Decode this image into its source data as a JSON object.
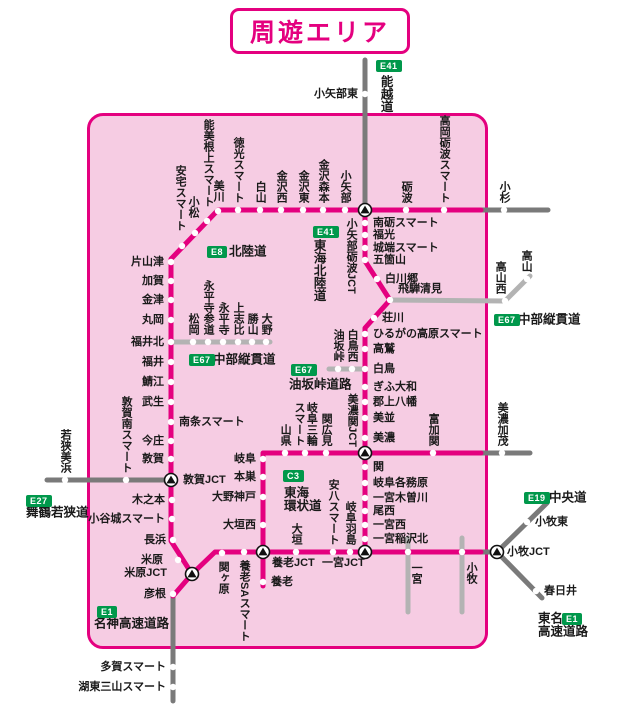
{
  "title": {
    "text": "周遊エリア"
  },
  "colors": {
    "pink": "#e4007f",
    "gray": "#7a7a7a",
    "lightgray": "#b3b3b3",
    "area_fill": "#f6cce3",
    "badge_green": "#00984b",
    "text": "#1a1a1a"
  },
  "map": {
    "area": {
      "x": 87,
      "y": 113,
      "w": 395,
      "h": 530
    },
    "lines": [
      {
        "name": "noetsu-expressway-line",
        "color": "gray",
        "points": [
          [
            365,
            60
          ],
          [
            365,
            208
          ]
        ]
      },
      {
        "name": "hokuriku-east-ext-line",
        "color": "gray",
        "points": [
          [
            481,
            210
          ],
          [
            548,
            210
          ]
        ]
      },
      {
        "name": "chubu-jukan-takayama-line",
        "color": "lightgray",
        "points": [
          [
            389,
            300
          ],
          [
            505,
            301
          ],
          [
            530,
            276
          ]
        ]
      },
      {
        "name": "chubu-jukan-fukui-line",
        "color": "lightgray",
        "points": [
          [
            172,
            342
          ],
          [
            270,
            342
          ]
        ]
      },
      {
        "name": "maizuru-wakasa-line",
        "color": "gray",
        "points": [
          [
            47,
            480
          ],
          [
            171,
            480
          ]
        ]
      },
      {
        "name": "aburasakatoge-line",
        "color": "lightgray",
        "points": [
          [
            329,
            369
          ],
          [
            364,
            369
          ]
        ]
      },
      {
        "name": "minokamo-ext-line",
        "color": "gray",
        "points": [
          [
            481,
            453
          ],
          [
            530,
            453
          ]
        ]
      },
      {
        "name": "ichinomiya-stub-line",
        "color": "lightgray",
        "points": [
          [
            408,
            538
          ],
          [
            408,
            612
          ]
        ]
      },
      {
        "name": "komaki-stub-line",
        "color": "lightgray",
        "points": [
          [
            462,
            538
          ],
          [
            462,
            612
          ]
        ]
      },
      {
        "name": "chuo-expressway-line",
        "color": "gray",
        "points": [
          [
            497,
            552
          ],
          [
            547,
            503
          ]
        ]
      },
      {
        "name": "tomei-expressway-line",
        "color": "gray",
        "points": [
          [
            497,
            552
          ],
          [
            542,
            598
          ]
        ]
      },
      {
        "name": "meishin-east-ext-line",
        "color": "gray",
        "points": [
          [
            481,
            552
          ],
          [
            497,
            552
          ]
        ]
      },
      {
        "name": "meishin-south-ext-line",
        "color": "gray",
        "points": [
          [
            173,
            596
          ],
          [
            173,
            701
          ]
        ]
      },
      {
        "name": "hokuriku-expressway-line",
        "color": "pink",
        "points": [
          [
            481,
            210
          ],
          [
            218,
            210
          ],
          [
            171,
            259
          ],
          [
            171,
            541
          ],
          [
            192,
            574
          ],
          [
            173,
            596
          ]
        ]
      },
      {
        "name": "tokai-hokuriku-expressway-line",
        "color": "pink",
        "points": [
          [
            365,
            209
          ],
          [
            365,
            261
          ],
          [
            390,
            300
          ],
          [
            365,
            328
          ],
          [
            365,
            552
          ]
        ]
      },
      {
        "name": "tokai-kanjo-expressway-line",
        "color": "pink",
        "points": [
          [
            481,
            453
          ],
          [
            263,
            453
          ],
          [
            263,
            552
          ]
        ]
      },
      {
        "name": "meishin-expressway-line",
        "color": "pink",
        "points": [
          [
            192,
            574
          ],
          [
            215,
            552
          ],
          [
            481,
            552
          ]
        ]
      },
      {
        "name": "yoro-spur-line",
        "color": "pink",
        "points": [
          [
            263,
            552
          ],
          [
            263,
            586
          ]
        ]
      }
    ],
    "stations": [
      {
        "n": "小矢部東",
        "x": 365,
        "y": 94,
        "p": "left"
      },
      {
        "n": "高岡砺波スマート",
        "x": 444,
        "y": 210,
        "p": "up"
      },
      {
        "n": "砺波",
        "x": 406,
        "y": 210,
        "p": "up"
      },
      {
        "n": "小杉",
        "x": 504,
        "y": 210,
        "p": "up"
      },
      {
        "n": "小矢部",
        "x": 345,
        "y": 210,
        "p": "up"
      },
      {
        "n": "金沢森本",
        "x": 323,
        "y": 210,
        "p": "up"
      },
      {
        "n": "金沢東",
        "x": 303,
        "y": 210,
        "p": "up"
      },
      {
        "n": "金沢西",
        "x": 281,
        "y": 210,
        "p": "up"
      },
      {
        "n": "白山",
        "x": 260,
        "y": 210,
        "p": "up"
      },
      {
        "n": "徳光スマート",
        "x": 238,
        "y": 210,
        "p": "up"
      },
      {
        "n": "美川",
        "x": 218,
        "y": 211,
        "p": "up",
        "dy": -2
      },
      {
        "n": "能美根上スマート",
        "x": 207,
        "y": 221,
        "p": "up",
        "dx": 1,
        "dy": -7
      },
      {
        "n": "小松",
        "x": 195,
        "y": 233,
        "p": "up",
        "dx": -2,
        "dy": -8
      },
      {
        "n": "安宅スマート",
        "x": 182,
        "y": 246,
        "p": "up",
        "dx": -2,
        "dy": -8
      },
      {
        "n": "片山津",
        "x": 171,
        "y": 262,
        "p": "left"
      },
      {
        "n": "加賀",
        "x": 171,
        "y": 281,
        "p": "left"
      },
      {
        "n": "金津",
        "x": 171,
        "y": 300,
        "p": "left"
      },
      {
        "n": "丸岡",
        "x": 171,
        "y": 320,
        "p": "left"
      },
      {
        "n": "福井北",
        "x": 171,
        "y": 342,
        "p": "left"
      },
      {
        "n": "福井",
        "x": 171,
        "y": 362,
        "p": "left"
      },
      {
        "n": "鯖江",
        "x": 171,
        "y": 382,
        "p": "left"
      },
      {
        "n": "武生",
        "x": 171,
        "y": 402,
        "p": "left"
      },
      {
        "n": "南条スマート",
        "x": 171,
        "y": 422,
        "p": "right"
      },
      {
        "n": "今庄",
        "x": 171,
        "y": 441,
        "p": "left"
      },
      {
        "n": "敦賀",
        "x": 171,
        "y": 459,
        "p": "left"
      },
      {
        "n": "木之本",
        "x": 172,
        "y": 500,
        "p": "left"
      },
      {
        "n": "小谷城スマート",
        "x": 172,
        "y": 519,
        "p": "left"
      },
      {
        "n": "長浜",
        "x": 173,
        "y": 540,
        "p": "left"
      },
      {
        "n": "米原",
        "x": 178,
        "y": 560,
        "p": "left",
        "dx": -8
      },
      {
        "n": "彦根",
        "x": 173,
        "y": 594,
        "p": "left"
      },
      {
        "n": "多賀スマート",
        "x": 173,
        "y": 667,
        "p": "left"
      },
      {
        "n": "湖東三山スマート",
        "x": 173,
        "y": 687,
        "p": "left"
      },
      {
        "n": "松岡",
        "x": 193,
        "y": 342,
        "p": "up"
      },
      {
        "n": "永平寺参道",
        "x": 208,
        "y": 342,
        "p": "up"
      },
      {
        "n": "永平寺",
        "x": 223,
        "y": 342,
        "p": "up"
      },
      {
        "n": "上志比",
        "x": 238,
        "y": 342,
        "p": "up"
      },
      {
        "n": "勝山",
        "x": 252,
        "y": 342,
        "p": "up"
      },
      {
        "n": "大野",
        "x": 266,
        "y": 342,
        "p": "up"
      },
      {
        "n": "敦賀南スマート",
        "x": 126,
        "y": 480,
        "p": "up"
      },
      {
        "n": "若狭美浜",
        "x": 65,
        "y": 480,
        "p": "up"
      },
      {
        "n": "南砺スマート",
        "x": 365,
        "y": 223,
        "p": "right"
      },
      {
        "n": "福光",
        "x": 365,
        "y": 235,
        "p": "right"
      },
      {
        "n": "城端スマート",
        "x": 365,
        "y": 248,
        "p": "right"
      },
      {
        "n": "五箇山",
        "x": 365,
        "y": 260,
        "p": "right"
      },
      {
        "n": "白川郷",
        "x": 377,
        "y": 279,
        "p": "right"
      },
      {
        "n": "飛騨清見",
        "x": 390,
        "y": 300,
        "p": "right",
        "dy": -11
      },
      {
        "n": "荘川",
        "x": 374,
        "y": 318,
        "p": "right"
      },
      {
        "n": "ひるがの高原スマート",
        "x": 365,
        "y": 334,
        "p": "right"
      },
      {
        "n": "高鷲",
        "x": 365,
        "y": 349,
        "p": "right"
      },
      {
        "n": "白鳥",
        "x": 365,
        "y": 369,
        "p": "right"
      },
      {
        "n": "ぎふ大和",
        "x": 365,
        "y": 387,
        "p": "right"
      },
      {
        "n": "郡上八幡",
        "x": 365,
        "y": 402,
        "p": "right"
      },
      {
        "n": "美並",
        "x": 365,
        "y": 418,
        "p": "right"
      },
      {
        "n": "美濃",
        "x": 365,
        "y": 438,
        "p": "right"
      },
      {
        "n": "油坂峠",
        "x": 338,
        "y": 369,
        "p": "up"
      },
      {
        "n": "白鳥西",
        "x": 352,
        "y": 369,
        "p": "up"
      },
      {
        "n": "高山西",
        "x": 505,
        "y": 301,
        "p": "up",
        "dx": -5
      },
      {
        "n": "高山",
        "x": 527,
        "y": 279,
        "p": "up",
        "dx": -1
      },
      {
        "n": "関",
        "x": 365,
        "y": 467,
        "p": "right"
      },
      {
        "n": "岐阜各務原",
        "x": 365,
        "y": 483,
        "p": "right"
      },
      {
        "n": "一宮木曽川",
        "x": 365,
        "y": 498,
        "p": "right"
      },
      {
        "n": "尾西",
        "x": 365,
        "y": 511,
        "p": "right"
      },
      {
        "n": "一宮西",
        "x": 365,
        "y": 525,
        "p": "right"
      },
      {
        "n": "一宮稲沢北",
        "x": 365,
        "y": 539,
        "p": "right"
      },
      {
        "n": "富加関",
        "x": 433,
        "y": 453,
        "p": "up"
      },
      {
        "n": "美濃加茂",
        "x": 502,
        "y": 453,
        "p": "up"
      },
      {
        "n": "山県",
        "x": 285,
        "y": 453,
        "p": "up"
      },
      {
        "n": "岐阜三輪\nスマート",
        "x": 305,
        "y": 453,
        "p": "up"
      },
      {
        "n": "関広見",
        "x": 326,
        "y": 453,
        "p": "up"
      },
      {
        "n": "岐阜",
        "x": 263,
        "y": 459,
        "p": "left"
      },
      {
        "n": "本巣",
        "x": 263,
        "y": 477,
        "p": "left"
      },
      {
        "n": "大野神戸",
        "x": 263,
        "y": 497,
        "p": "left"
      },
      {
        "n": "大垣西",
        "x": 263,
        "y": 525,
        "p": "left"
      },
      {
        "n": "関ヶ原",
        "x": 222,
        "y": 553,
        "p": "down",
        "dx": 1
      },
      {
        "n": "養老SAスマート",
        "x": 244,
        "y": 552,
        "p": "down"
      },
      {
        "n": "大垣",
        "x": 296,
        "y": 552,
        "p": "up"
      },
      {
        "n": "安八スマート",
        "x": 333,
        "y": 552,
        "p": "up"
      },
      {
        "n": "岐阜羽島",
        "x": 350,
        "y": 552,
        "p": "up"
      },
      {
        "n": "養老",
        "x": 263,
        "y": 582,
        "p": "right"
      },
      {
        "n": "",
        "x": 408,
        "y": 552
      },
      {
        "n": "",
        "x": 462,
        "y": 552
      },
      {
        "n": "小牧東",
        "x": 527,
        "y": 522,
        "p": "right"
      },
      {
        "n": "春日井",
        "x": 536,
        "y": 591,
        "p": "right"
      }
    ],
    "junctions": [
      {
        "name": "小矢部砺波JCT",
        "x": 365,
        "y": 210
      },
      {
        "name": "敦賀JCT",
        "x": 171,
        "y": 480
      },
      {
        "name": "米原JCT",
        "x": 192,
        "y": 574
      },
      {
        "name": "美濃関JCT",
        "x": 365,
        "y": 453
      },
      {
        "name": "養老JCT",
        "x": 263,
        "y": 552
      },
      {
        "name": "一宮JCT",
        "x": 365,
        "y": 552
      },
      {
        "name": "小牧JCT",
        "x": 497,
        "y": 552
      }
    ],
    "labels": [
      {
        "t": "小矢部砺波JCT",
        "x": 351,
        "y": 218,
        "o": "v",
        "va": "top",
        "c": "sta"
      },
      {
        "t": "美濃関JCT",
        "x": 352,
        "y": 447,
        "o": "v",
        "va": "bottom",
        "c": "sta"
      },
      {
        "t": "敦賀JCT",
        "x": 183,
        "y": 480,
        "o": "h",
        "ha": "left",
        "va": "center",
        "c": "sta"
      },
      {
        "t": "米原JCT",
        "x": 167,
        "y": 573,
        "o": "h",
        "ha": "right",
        "va": "center",
        "c": "sta"
      },
      {
        "t": "養老JCT",
        "x": 272,
        "y": 563,
        "o": "h",
        "ha": "left",
        "va": "center",
        "c": "sta"
      },
      {
        "t": "一宮JCT",
        "x": 322,
        "y": 563,
        "o": "h",
        "ha": "left",
        "va": "center",
        "c": "sta"
      },
      {
        "t": "小牧JCT",
        "x": 507,
        "y": 552,
        "o": "h",
        "ha": "left",
        "va": "center",
        "c": "sta"
      },
      {
        "t": "一宮",
        "x": 416,
        "y": 562,
        "o": "v",
        "va": "top",
        "c": "sta"
      },
      {
        "t": "小牧",
        "x": 471,
        "y": 562,
        "o": "v",
        "va": "top",
        "c": "sta"
      },
      {
        "t": "能越道",
        "x": 385,
        "y": 75,
        "o": "v",
        "va": "top",
        "c": "route"
      },
      {
        "t": "東海北陸道",
        "x": 318,
        "y": 239,
        "o": "v",
        "va": "top",
        "c": "route"
      },
      {
        "t": "北陸道",
        "x": 229,
        "y": 252,
        "o": "h",
        "ha": "left",
        "va": "center",
        "c": "route"
      },
      {
        "t": "中部縦貫道",
        "x": 213,
        "y": 360,
        "o": "h",
        "ha": "left",
        "va": "center",
        "c": "route"
      },
      {
        "t": "中部縦貫道",
        "x": 518,
        "y": 320,
        "o": "h",
        "ha": "left",
        "va": "center",
        "c": "route"
      },
      {
        "t": "油坂峠道路",
        "x": 289,
        "y": 385,
        "o": "h",
        "ha": "left",
        "va": "center",
        "c": "route"
      },
      {
        "t": "東海\n環状道",
        "x": 284,
        "y": 487,
        "o": "h",
        "ha": "left",
        "va": "top",
        "c": "route"
      },
      {
        "t": "舞鶴若狭道",
        "x": 26,
        "y": 513,
        "o": "h",
        "ha": "left",
        "va": "center",
        "c": "route"
      },
      {
        "t": "名神高速道路",
        "x": 94,
        "y": 624,
        "o": "h",
        "ha": "left",
        "va": "center",
        "c": "route"
      },
      {
        "t": "中央道",
        "x": 549,
        "y": 498,
        "o": "h",
        "ha": "left",
        "va": "center",
        "c": "route"
      },
      {
        "t": "東名",
        "x": 538,
        "y": 619,
        "o": "h",
        "ha": "left",
        "va": "center",
        "c": "route"
      },
      {
        "t": "高速道路",
        "x": 538,
        "y": 632,
        "o": "h",
        "ha": "left",
        "va": "center",
        "c": "route"
      }
    ],
    "badges": [
      {
        "code": "E41",
        "x": 376,
        "y": 60
      },
      {
        "code": "E8",
        "x": 207,
        "y": 246
      },
      {
        "code": "E41",
        "x": 313,
        "y": 226
      },
      {
        "code": "E67",
        "x": 189,
        "y": 354
      },
      {
        "code": "E67",
        "x": 291,
        "y": 364
      },
      {
        "code": "E67",
        "x": 494,
        "y": 314
      },
      {
        "code": "C3",
        "x": 283,
        "y": 470
      },
      {
        "code": "E27",
        "x": 26,
        "y": 495
      },
      {
        "code": "E19",
        "x": 524,
        "y": 492
      },
      {
        "code": "E1",
        "x": 97,
        "y": 606
      },
      {
        "code": "E1",
        "x": 562,
        "y": 613
      }
    ]
  }
}
